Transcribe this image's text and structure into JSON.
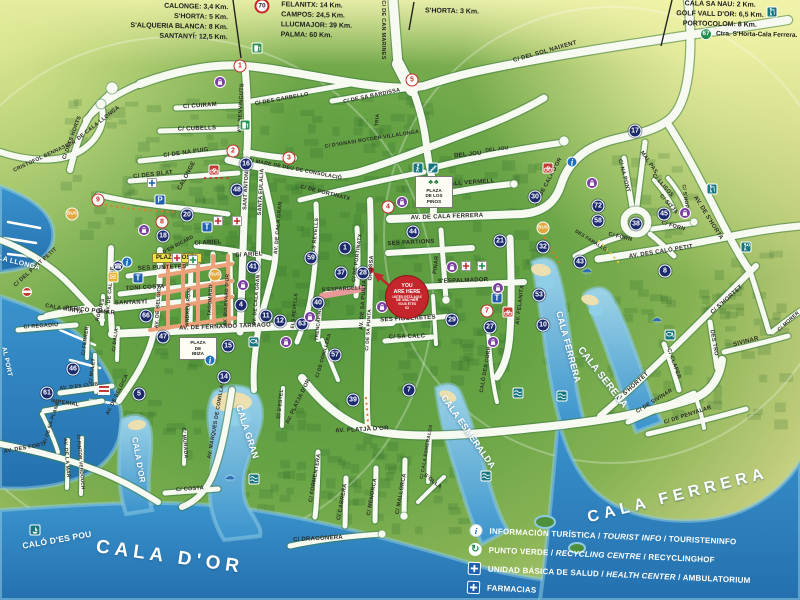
{
  "map_title": "Cala d'Or tourist street map",
  "distance_panels": {
    "west": [
      "CALONGE: 3,4 Km.",
      "S'HORTA: 5 Km.",
      "S'ALQUERIA BLANCA: 8 Km.",
      "SANTANYÍ: 12,5 Km."
    ],
    "north": [
      "FELANITX: 14 Km.",
      "CAMPOS: 24,5 Km.",
      "LLUCMAJOR: 39 Km.",
      "PALMA: 60 Km."
    ],
    "shorta": "S'HORTA: 3 Km.",
    "east": [
      "CALA SA NAU: 2 Km.",
      "GOLF VALL D'OR: 6,5 Km.",
      "PORTOCOLOM: 8 Km."
    ],
    "road_sign_70": "70",
    "road_sign_67": "67",
    "road_67_text": "Ctra. S'Horta-Cala Ferrera."
  },
  "legend": {
    "rows": [
      {
        "icon": "info",
        "es": "INFORMACIÓN TURÍSTICA",
        "en": "TOURIST INFO",
        "de": "TOURISTENINFO"
      },
      {
        "icon": "recycle",
        "es": "PUNTO VERDE",
        "en": "RECYCLING CENTRE",
        "de": "RECYCLINGHOF"
      },
      {
        "icon": "health",
        "es": "UNIDAD BÁSICA DE SALUD",
        "en": "HEALTH CENTER",
        "de": "AMBULATORIUM"
      },
      {
        "icon": "health",
        "es": "FARMACIAS",
        "en": "",
        "de": ""
      }
    ]
  },
  "you_are_here": {
    "lines": [
      "YOU",
      "ARE HERE",
      "USTED ESTÁ AQUÍ",
      "SIE SIND HIER",
      "VOUS ÊTES",
      "ICI"
    ]
  },
  "water_labels": [
    {
      "t": "CALA D'OR",
      "x": 170,
      "y": 557,
      "r": 8,
      "s": 19,
      "big": true
    },
    {
      "t": "CALA FERRERA",
      "x": 678,
      "y": 496,
      "r": -14,
      "s": 16,
      "big": true
    },
    {
      "t": "CALA D'OR",
      "x": 138,
      "y": 460,
      "r": 80,
      "s": 8
    },
    {
      "t": "CALA GRAN",
      "x": 247,
      "y": 432,
      "r": 72,
      "s": 9
    },
    {
      "t": "CALA ESMERALDA",
      "x": 468,
      "y": 432,
      "r": 55,
      "s": 9
    },
    {
      "t": "CALA SERENA",
      "x": 602,
      "y": 378,
      "r": 52,
      "s": 10
    },
    {
      "t": "CALA FERRERA",
      "x": 568,
      "y": 347,
      "r": 75,
      "s": 9
    },
    {
      "t": "CALA LLONGA",
      "x": 14,
      "y": 262,
      "r": 14,
      "s": 7
    },
    {
      "t": "CALÓ D'ES POU",
      "x": 57,
      "y": 540,
      "r": -10,
      "s": 8.5
    },
    {
      "t": "AL PORT",
      "x": 6,
      "y": 362,
      "r": 78,
      "s": 6.5
    }
  ],
  "plazas": [
    {
      "name": "PLAZA COSTA",
      "x": 177,
      "y": 258,
      "kind": "strip"
    },
    {
      "name": "PLAZA DE LOS PINOS",
      "lines": [
        "PLAZA",
        "DE LOS",
        "PINOS"
      ],
      "x": 432,
      "y": 192,
      "kind": "box",
      "trees": true
    },
    {
      "name": "PLAZA DE IBIZA",
      "lines": [
        "PLAZA",
        "DE",
        "IBIZA"
      ],
      "x": 196,
      "y": 353,
      "kind": "box",
      "trees": false
    }
  ],
  "streets": [
    {
      "t": "C/ DEL SOL NAIXENT",
      "x": 545,
      "y": 52,
      "r": -16
    },
    {
      "t": "C/ DE CAN MARINES",
      "x": 382,
      "y": 30,
      "r": 90,
      "s": 5.5
    },
    {
      "t": "CALONGE",
      "x": 187,
      "y": 176,
      "r": -62
    },
    {
      "t": "C/ CUIRAM",
      "x": 200,
      "y": 106,
      "r": -4
    },
    {
      "t": "C/ CUBELLS",
      "x": 197,
      "y": 129,
      "r": -2
    },
    {
      "t": "C/ DE NA PUIG",
      "x": 186,
      "y": 153,
      "r": -8
    },
    {
      "t": "AV. BENVINGUTS",
      "x": 242,
      "y": 108,
      "r": -87,
      "s": 5.5
    },
    {
      "t": "SANT ANTONI",
      "x": 247,
      "y": 190,
      "r": -87,
      "s": 5.5
    },
    {
      "t": "SANTA EULALIA",
      "x": 262,
      "y": 192,
      "r": -87,
      "s": 5.5
    },
    {
      "t": "C/ DES GARBELLO",
      "x": 282,
      "y": 100,
      "r": -10,
      "s": 5.5
    },
    {
      "t": "C/ DE SA BARDISSA",
      "x": 372,
      "y": 97,
      "r": -12,
      "s": 5.5
    },
    {
      "t": "C/ D'IGNASI ROTGER VILLALONGA",
      "x": 372,
      "y": 140,
      "r": -9,
      "s": 5.2
    },
    {
      "t": "C/ MARE DE DEU DE CONSOLACIÓ",
      "x": 295,
      "y": 170,
      "r": 11,
      "s": 5.2
    },
    {
      "t": "C/ DE PORTINATX",
      "x": 325,
      "y": 194,
      "r": 14,
      "s": 5.5
    },
    {
      "t": "C/ DE PORTINATX",
      "x": 358,
      "y": 258,
      "r": -82,
      "s": 5.2
    },
    {
      "t": "DEL JOU",
      "x": 468,
      "y": 155,
      "r": -6
    },
    {
      "t": "CALL VERMELL",
      "x": 470,
      "y": 183,
      "r": -4
    },
    {
      "t": "AV. DE CALA FERRERA",
      "x": 447,
      "y": 217,
      "r": -2
    },
    {
      "t": "AV. DE CALA D'OR",
      "x": 549,
      "y": 182,
      "r": -62,
      "s": 5.5
    },
    {
      "t": "SES PARTIONS",
      "x": 411,
      "y": 243,
      "r": -3
    },
    {
      "t": "PINAR",
      "x": 437,
      "y": 265,
      "r": -83,
      "s": 5.5
    },
    {
      "t": "S'ESPALMADOR",
      "x": 463,
      "y": 281,
      "r": -2
    },
    {
      "t": "AV. FELANITX",
      "x": 521,
      "y": 305,
      "r": -83,
      "s": 5.5
    },
    {
      "t": "CALÓ DES CORRAL",
      "x": 487,
      "y": 366,
      "r": -80,
      "s": 5.2
    },
    {
      "t": "SES FIGUERETES",
      "x": 408,
      "y": 319,
      "r": -3
    },
    {
      "t": "C/ SA CALC",
      "x": 407,
      "y": 337,
      "r": -2
    },
    {
      "t": "AV. DE SA PUNTA",
      "x": 364,
      "y": 305,
      "r": -86,
      "s": 5.5
    },
    {
      "t": "GROSSA",
      "x": 372,
      "y": 268,
      "r": -86,
      "s": 5.5
    },
    {
      "t": "AV. DE FERNANDO TARRAGO",
      "x": 225,
      "y": 327,
      "r": -2
    },
    {
      "t": "PERICO POMAR",
      "x": 90,
      "y": 311,
      "r": 6
    },
    {
      "t": "SANTANYÍ",
      "x": 131,
      "y": 303,
      "r": -2
    },
    {
      "t": "TONI COSTA",
      "x": 145,
      "y": 288,
      "r": -3
    },
    {
      "t": "SES PUNTETES",
      "x": 162,
      "y": 268,
      "r": -2
    },
    {
      "t": "AV. DE CALONGE",
      "x": 111,
      "y": 290,
      "r": -84,
      "s": 5.2
    },
    {
      "t": "AV. DE BELGICA",
      "x": 159,
      "y": 306,
      "r": -86,
      "s": 5.2
    },
    {
      "t": "AV. DE BELGICA",
      "x": 118,
      "y": 395,
      "r": -64,
      "s": 5.2
    },
    {
      "t": "ANDREU ROIG",
      "x": 189,
      "y": 307,
      "r": -87,
      "s": 5
    },
    {
      "t": "TAGOMAGO",
      "x": 211,
      "y": 300,
      "r": -87,
      "s": 5
    },
    {
      "t": "AV. BULEVARD D'OR",
      "x": 228,
      "y": 300,
      "r": -87,
      "s": 4.8
    },
    {
      "t": "D'EN RICARD",
      "x": 179,
      "y": 246,
      "r": -28,
      "s": 4.8
    },
    {
      "t": "C/ ARIEL",
      "x": 208,
      "y": 243,
      "r": -3
    },
    {
      "t": "C/ ARIEL",
      "x": 249,
      "y": 255,
      "r": -3
    },
    {
      "t": "C/ DES BLAT",
      "x": 153,
      "y": 175,
      "r": -6
    },
    {
      "t": "C/ DETS HORTS",
      "x": 73,
      "y": 138,
      "r": -70,
      "s": 5.5
    },
    {
      "t": "DE CALA LLONGA",
      "x": 99,
      "y": 124,
      "r": -38,
      "s": 5.5
    },
    {
      "t": "CRISTOFOL BENNASSER",
      "x": 45,
      "y": 157,
      "r": -25,
      "s": 5.2
    },
    {
      "t": "C/ DEL PORT PETIT",
      "x": 36,
      "y": 268,
      "r": -42,
      "s": 5.5
    },
    {
      "t": "CALA MURTA",
      "x": 64,
      "y": 310,
      "r": 10,
      "s": 5.5
    },
    {
      "t": "C/ REGADIU",
      "x": 41,
      "y": 327,
      "r": -4,
      "s": 5.5
    },
    {
      "t": "ROQUES",
      "x": 101,
      "y": 310,
      "r": -75,
      "s": 5
    },
    {
      "t": "C/ FERRER",
      "x": 86,
      "y": 341,
      "r": -82,
      "s": 5
    },
    {
      "t": "C/ MULET",
      "x": 93,
      "y": 371,
      "r": -83,
      "s": 5
    },
    {
      "t": "C/ DALIA",
      "x": 116,
      "y": 340,
      "r": -83,
      "s": 5
    },
    {
      "t": "AV. D'ES CLUB",
      "x": 79,
      "y": 387,
      "r": -6,
      "s": 5
    },
    {
      "t": "IMPERIAL",
      "x": 65,
      "y": 404,
      "r": 8,
      "s": 5.5
    },
    {
      "t": "C/ DE NA PLANA",
      "x": 52,
      "y": 423,
      "r": -72,
      "s": 5
    },
    {
      "t": "AV. DES FORTÍ",
      "x": 25,
      "y": 449,
      "r": -10,
      "s": 5.5
    },
    {
      "t": "AV. MARQUÉS DE COMILLAS",
      "x": 217,
      "y": 420,
      "r": -80,
      "s": 5.2
    },
    {
      "t": "C/ COSTA",
      "x": 190,
      "y": 490,
      "r": -4,
      "s": 5.5
    },
    {
      "t": "C/ MURADA",
      "x": 184,
      "y": 443,
      "r": 85,
      "s": 5
    },
    {
      "t": "AV. DE LA MAR",
      "x": 66,
      "y": 458,
      "r": 85,
      "s": 5
    },
    {
      "t": "C/ PINTOR VERDOUCH",
      "x": 80,
      "y": 462,
      "r": 85,
      "s": 4.6
    },
    {
      "t": "C/ S'ESTEL",
      "x": 281,
      "y": 404,
      "r": -84,
      "s": 5
    },
    {
      "t": "AV. PLATJA D'OR",
      "x": 299,
      "y": 402,
      "r": -64,
      "s": 5.5
    },
    {
      "t": "AV. PLATJA D'OR",
      "x": 362,
      "y": 430,
      "r": -3
    },
    {
      "t": "C/ FORMENTERA",
      "x": 316,
      "y": 478,
      "r": -80,
      "s": 5.5
    },
    {
      "t": "C/ CABRERA",
      "x": 343,
      "y": 502,
      "r": -80,
      "s": 5.5
    },
    {
      "t": "C/ MENORCA",
      "x": 373,
      "y": 497,
      "r": -80,
      "s": 5.5
    },
    {
      "t": "C/ MALLORCA",
      "x": 402,
      "y": 494,
      "r": -80,
      "s": 5.5
    },
    {
      "t": "C/ DRAGONERA",
      "x": 318,
      "y": 539,
      "r": -3
    },
    {
      "t": "C/ CALA ESMERALDA",
      "x": 428,
      "y": 452,
      "r": -80,
      "s": 4.8
    },
    {
      "t": "S'OLLA",
      "x": 432,
      "y": 482,
      "r": 38,
      "s": 5.5
    },
    {
      "t": "S'ESPARDELL",
      "x": 342,
      "y": 290,
      "r": -3,
      "s": 5.5
    },
    {
      "t": "TRENCAPINS",
      "x": 320,
      "y": 324,
      "r": -84,
      "s": 4.8
    },
    {
      "t": "C/ DE CONILLERA",
      "x": 325,
      "y": 356,
      "r": -74,
      "s": 4.8
    },
    {
      "t": "ELS REVELLS",
      "x": 316,
      "y": 237,
      "r": -84,
      "s": 5.2
    },
    {
      "t": "ELS REVELLS",
      "x": 296,
      "y": 311,
      "r": -84,
      "s": 4.8
    },
    {
      "t": "AV. DE CALA GRAN",
      "x": 279,
      "y": 228,
      "r": -85,
      "s": 5.2
    },
    {
      "t": "AV. DE CALA GRAN",
      "x": 257,
      "y": 300,
      "r": -85,
      "s": 5
    },
    {
      "t": "MAL PAS",
      "x": 648,
      "y": 163,
      "r": 55,
      "s": 5.5
    },
    {
      "t": "C/ NA PONT",
      "x": 623,
      "y": 176,
      "r": 75,
      "s": 5.5
    },
    {
      "t": "C/ LLISOS",
      "x": 662,
      "y": 186,
      "r": 48,
      "s": 5.5
    },
    {
      "t": "C/ SITJA",
      "x": 668,
      "y": 205,
      "r": 48,
      "s": 5.5
    },
    {
      "t": "AV. DE S'HORTA",
      "x": 708,
      "y": 218,
      "r": 58
    },
    {
      "t": "C/ S'HORTA",
      "x": 685,
      "y": 200,
      "r": 82,
      "s": 5
    },
    {
      "t": "C/ FORN",
      "x": 620,
      "y": 238,
      "r": 14,
      "s": 5.5
    },
    {
      "t": "C/ FORN",
      "x": 673,
      "y": 227,
      "r": 16,
      "s": 5.5
    },
    {
      "t": "DES FARALLÓ",
      "x": 590,
      "y": 242,
      "r": 32,
      "s": 4.8
    },
    {
      "t": "AV. DES CALÓ PETIT",
      "x": 661,
      "y": 252,
      "r": -9
    },
    {
      "t": "C/ S'HORTET",
      "x": 727,
      "y": 300,
      "r": -42
    },
    {
      "t": "C/ S'HORTET",
      "x": 633,
      "y": 387,
      "r": -42
    },
    {
      "t": "DES TRO",
      "x": 713,
      "y": 343,
      "r": 80,
      "s": 5.5
    },
    {
      "t": "SIVINAR",
      "x": 746,
      "y": 342,
      "r": -14
    },
    {
      "t": "C/ MORER",
      "x": 789,
      "y": 322,
      "r": -42,
      "s": 5
    },
    {
      "t": "C/ CLAPER",
      "x": 673,
      "y": 364,
      "r": 70,
      "s": 5.5
    },
    {
      "t": "C/ DE SIVINAR",
      "x": 655,
      "y": 402,
      "r": -32,
      "s": 5.5
    },
    {
      "t": "C/ DE PENYALAR",
      "x": 688,
      "y": 416,
      "r": -18,
      "s": 5.5
    },
    {
      "t": "TRIA",
      "x": 378,
      "y": 120,
      "r": -85,
      "s": 5
    },
    {
      "t": "DEL JOU",
      "x": 497,
      "y": 150,
      "r": -6,
      "s": 5
    },
    {
      "t": "C/ DE SA PUNTA",
      "x": 370,
      "y": 330,
      "r": -86,
      "s": 4.8
    }
  ],
  "markers": [
    {
      "n": "1",
      "x": 240,
      "y": 66,
      "k": "r"
    },
    {
      "n": "5",
      "x": 412,
      "y": 80,
      "k": "r"
    },
    {
      "n": "2",
      "x": 233,
      "y": 151,
      "k": "r"
    },
    {
      "n": "3",
      "x": 289,
      "y": 158,
      "k": "r"
    },
    {
      "n": "4",
      "x": 388,
      "y": 207,
      "k": "r"
    },
    {
      "n": "9",
      "x": 98,
      "y": 200,
      "k": "r"
    },
    {
      "n": "8",
      "x": 162,
      "y": 222,
      "k": "r"
    },
    {
      "n": "7",
      "x": 487,
      "y": 311,
      "k": "r"
    },
    {
      "n": "16",
      "x": 246,
      "y": 164,
      "k": "n"
    },
    {
      "n": "48",
      "x": 237,
      "y": 190,
      "k": "n"
    },
    {
      "n": "20",
      "x": 187,
      "y": 215,
      "k": "n"
    },
    {
      "n": "18",
      "x": 163,
      "y": 236,
      "k": "n"
    },
    {
      "n": "41",
      "x": 253,
      "y": 267,
      "k": "n"
    },
    {
      "n": "59",
      "x": 311,
      "y": 258,
      "k": "n"
    },
    {
      "n": "1",
      "x": 345,
      "y": 248,
      "k": "n"
    },
    {
      "n": "37",
      "x": 341,
      "y": 273,
      "k": "n"
    },
    {
      "n": "28",
      "x": 363,
      "y": 273,
      "k": "n"
    },
    {
      "n": "44",
      "x": 413,
      "y": 232,
      "k": "n"
    },
    {
      "n": "21",
      "x": 500,
      "y": 241,
      "k": "n"
    },
    {
      "n": "30",
      "x": 535,
      "y": 197,
      "k": "n"
    },
    {
      "n": "32",
      "x": 543,
      "y": 247,
      "k": "n"
    },
    {
      "n": "17",
      "x": 635,
      "y": 131,
      "k": "n"
    },
    {
      "n": "72",
      "x": 598,
      "y": 206,
      "k": "n"
    },
    {
      "n": "58",
      "x": 598,
      "y": 221,
      "k": "n"
    },
    {
      "n": "38",
      "x": 636,
      "y": 224,
      "k": "n"
    },
    {
      "n": "45",
      "x": 664,
      "y": 214,
      "k": "n"
    },
    {
      "n": "8",
      "x": 665,
      "y": 271,
      "k": "n"
    },
    {
      "n": "43",
      "x": 580,
      "y": 262,
      "k": "n"
    },
    {
      "n": "53",
      "x": 539,
      "y": 295,
      "k": "n"
    },
    {
      "n": "10",
      "x": 543,
      "y": 325,
      "k": "n"
    },
    {
      "n": "29",
      "x": 452,
      "y": 320,
      "k": "n"
    },
    {
      "n": "27",
      "x": 490,
      "y": 327,
      "k": "n"
    },
    {
      "n": "63",
      "x": 302,
      "y": 324,
      "k": "n"
    },
    {
      "n": "40",
      "x": 318,
      "y": 303,
      "k": "n"
    },
    {
      "n": "11",
      "x": 266,
      "y": 316,
      "k": "n"
    },
    {
      "n": "12",
      "x": 280,
      "y": 321,
      "k": "n"
    },
    {
      "n": "4",
      "x": 241,
      "y": 305,
      "k": "n"
    },
    {
      "n": "15",
      "x": 228,
      "y": 346,
      "k": "n"
    },
    {
      "n": "14",
      "x": 224,
      "y": 377,
      "k": "n"
    },
    {
      "n": "57",
      "x": 335,
      "y": 355,
      "k": "n"
    },
    {
      "n": "39",
      "x": 353,
      "y": 400,
      "k": "n"
    },
    {
      "n": "7",
      "x": 409,
      "y": 390,
      "k": "n"
    },
    {
      "n": "46",
      "x": 73,
      "y": 369,
      "k": "n"
    },
    {
      "n": "61",
      "x": 47,
      "y": 393,
      "k": "n"
    },
    {
      "n": "5",
      "x": 139,
      "y": 394,
      "k": "n"
    },
    {
      "n": "47",
      "x": 163,
      "y": 337,
      "k": "n"
    },
    {
      "n": "66",
      "x": 146,
      "y": 316,
      "k": "n"
    },
    {
      "n": "BUS",
      "x": 72,
      "y": 214,
      "k": "b"
    },
    {
      "n": "BUS",
      "x": 543,
      "y": 228,
      "k": "b"
    },
    {
      "n": "BUS",
      "x": 215,
      "y": 275,
      "k": "b"
    }
  ],
  "icons": [
    {
      "k": "walking",
      "x": 418,
      "y": 168
    },
    {
      "k": "stairs",
      "x": 433,
      "y": 168
    },
    {
      "k": "golf",
      "x": 772,
      "y": 12
    },
    {
      "k": "golf",
      "x": 712,
      "y": 189
    },
    {
      "k": "tennis",
      "x": 746,
      "y": 247
    },
    {
      "k": "diving",
      "x": 254,
      "y": 342
    },
    {
      "k": "diving",
      "x": 670,
      "y": 335
    },
    {
      "k": "waves",
      "x": 254,
      "y": 479
    },
    {
      "k": "waves",
      "x": 518,
      "y": 393
    },
    {
      "k": "waves",
      "x": 486,
      "y": 476
    },
    {
      "k": "waves",
      "x": 562,
      "y": 396
    },
    {
      "k": "boat",
      "x": 35,
      "y": 530
    },
    {
      "k": "fuel",
      "x": 257,
      "y": 48
    },
    {
      "k": "fuel",
      "x": 245,
      "y": 125
    },
    {
      "k": "parking",
      "x": 160,
      "y": 200
    },
    {
      "k": "taxi",
      "x": 138,
      "y": 278
    },
    {
      "k": "taxi",
      "x": 207,
      "y": 227
    },
    {
      "k": "taxi",
      "x": 497,
      "y": 298
    },
    {
      "k": "info",
      "x": 127,
      "y": 262
    },
    {
      "k": "info",
      "x": 210,
      "y": 360
    },
    {
      "k": "info",
      "x": 572,
      "y": 162
    },
    {
      "k": "post",
      "x": 113,
      "y": 277
    },
    {
      "k": "phone",
      "x": 118,
      "y": 266
    },
    {
      "k": "cross-red",
      "x": 218,
      "y": 221
    },
    {
      "k": "cross-red",
      "x": 237,
      "y": 221
    },
    {
      "k": "cross-red",
      "x": 177,
      "y": 258
    },
    {
      "k": "cross-red",
      "x": 466,
      "y": 266
    },
    {
      "k": "cross-green",
      "x": 193,
      "y": 260
    },
    {
      "k": "cross-green",
      "x": 482,
      "y": 266
    },
    {
      "k": "cross-blue",
      "x": 152,
      "y": 183
    },
    {
      "k": "shopping",
      "x": 220,
      "y": 82
    },
    {
      "k": "shopping",
      "x": 144,
      "y": 230
    },
    {
      "k": "shopping",
      "x": 402,
      "y": 202
    },
    {
      "k": "shopping",
      "x": 592,
      "y": 183
    },
    {
      "k": "shopping",
      "x": 243,
      "y": 285
    },
    {
      "k": "shopping",
      "x": 310,
      "y": 317
    },
    {
      "k": "shopping",
      "x": 286,
      "y": 342
    },
    {
      "k": "shopping",
      "x": 452,
      "y": 267
    },
    {
      "k": "shopping",
      "x": 498,
      "y": 288
    },
    {
      "k": "shopping",
      "x": 493,
      "y": 342
    },
    {
      "k": "shopping",
      "x": 685,
      "y": 213
    },
    {
      "k": "shopping",
      "x": 382,
      "y": 307
    },
    {
      "k": "bike",
      "x": 214,
      "y": 170
    },
    {
      "k": "bike",
      "x": 548,
      "y": 168
    },
    {
      "k": "bike",
      "x": 508,
      "y": 312
    },
    {
      "k": "umbrella",
      "x": 230,
      "y": 480
    },
    {
      "k": "umbrella",
      "x": 587,
      "y": 273
    },
    {
      "k": "umbrella",
      "x": 657,
      "y": 322
    },
    {
      "k": "church",
      "x": 104,
      "y": 390
    },
    {
      "k": "monument",
      "x": 27,
      "y": 292
    },
    {
      "k": "sign70",
      "x": 262,
      "y": 6
    }
  ]
}
